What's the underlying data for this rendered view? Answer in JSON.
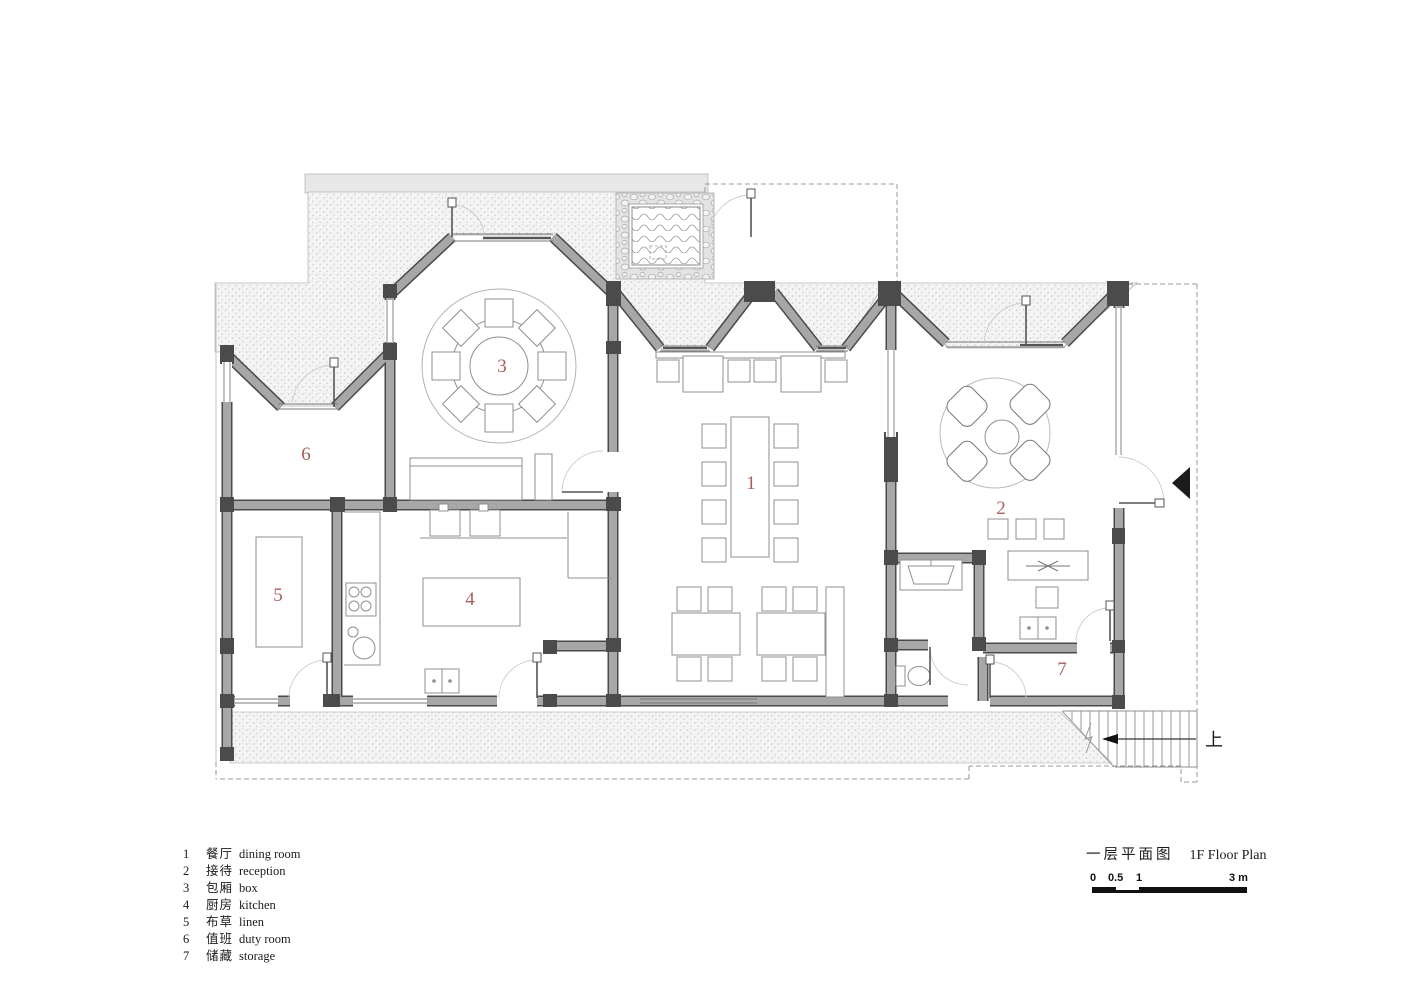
{
  "drawing": {
    "title_zh": "一层平面图",
    "title_en": "1F Floor Plan",
    "stairs_up_label": "上",
    "rooms": [
      {
        "num": "1",
        "zh": "餐厅",
        "en": "dining room"
      },
      {
        "num": "2",
        "zh": "接待",
        "en": "reception"
      },
      {
        "num": "3",
        "zh": "包厢",
        "en": "box"
      },
      {
        "num": "4",
        "zh": "厨房",
        "en": "kitchen"
      },
      {
        "num": "5",
        "zh": "布草",
        "en": "linen"
      },
      {
        "num": "6",
        "zh": "值班",
        "en": "duty room"
      },
      {
        "num": "7",
        "zh": "储藏",
        "en": "storage"
      }
    ],
    "scale_bar": {
      "tick_0": "0",
      "tick_05": "0.5",
      "tick_1": "1",
      "tick_3": "3 m"
    },
    "colors": {
      "wall_fill": "#a7a7a7",
      "wall_edge": "#4a4a4a",
      "column": "#4b4b4b",
      "room_number": "#a5605c",
      "furniture_line": "#8f8f8f",
      "stipple_dot": "#c0c0c0",
      "dashed_line": "#9a9a9a"
    }
  }
}
